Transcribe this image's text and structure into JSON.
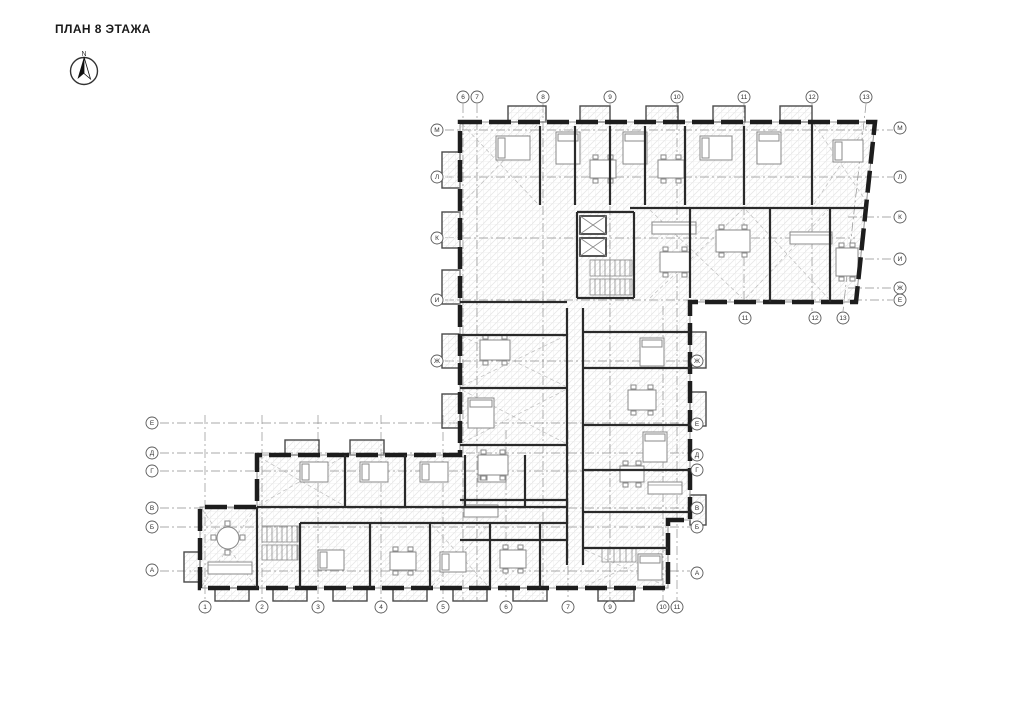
{
  "title": "ПЛАН 8 ЭТАЖА",
  "compass": {
    "north_label": "N"
  },
  "colors": {
    "wall": "#1d1d1d",
    "interior_wall": "#2a2a2a",
    "grid_line": "#8f8f8f",
    "bubble_stroke": "#5a5a5a",
    "bubble_text": "#333333",
    "furniture": "#8a8a8a",
    "balcony": "#4a4a4a",
    "diagonal": "#bdbdbd",
    "window": "#9a9a9a"
  },
  "axes": {
    "top_y": 97,
    "top": [
      {
        "label": "6",
        "x": 463
      },
      {
        "label": "7",
        "x": 477
      },
      {
        "label": "8",
        "x": 543
      },
      {
        "label": "9",
        "x": 610
      },
      {
        "label": "10",
        "x": 677
      },
      {
        "label": "11",
        "x": 744
      },
      {
        "label": "12",
        "x": 812
      },
      {
        "label": "13",
        "x": 866
      }
    ],
    "below_y": 318,
    "below_wing": [
      {
        "label": "11",
        "x": 745
      },
      {
        "label": "12",
        "x": 815
      },
      {
        "label": "13",
        "x": 843
      }
    ],
    "bottom_y": 607,
    "bottom": [
      {
        "label": "1",
        "x": 205
      },
      {
        "label": "2",
        "x": 262
      },
      {
        "label": "3",
        "x": 318
      },
      {
        "label": "4",
        "x": 381
      },
      {
        "label": "5",
        "x": 443
      },
      {
        "label": "6",
        "x": 506
      },
      {
        "label": "7",
        "x": 568
      },
      {
        "label": "9",
        "x": 610
      },
      {
        "label": "10",
        "x": 663
      },
      {
        "label": "11",
        "x": 677
      }
    ],
    "left_upper_x": 437,
    "left_upper": [
      {
        "label": "М",
        "y": 130
      },
      {
        "label": "Л",
        "y": 177
      },
      {
        "label": "К",
        "y": 238
      },
      {
        "label": "И",
        "y": 300
      },
      {
        "label": "Ж",
        "y": 361
      }
    ],
    "right_upper_x": 900,
    "right_upper": [
      {
        "label": "М",
        "y": 128
      },
      {
        "label": "Л",
        "y": 177
      },
      {
        "label": "К",
        "y": 217
      },
      {
        "label": "И",
        "y": 259
      },
      {
        "label": "Ж",
        "y": 288
      },
      {
        "label": "Е",
        "y": 300
      }
    ],
    "left_lower_x": 152,
    "left_lower": [
      {
        "label": "Е",
        "y": 423
      },
      {
        "label": "Д",
        "y": 453
      },
      {
        "label": "Г",
        "y": 471
      },
      {
        "label": "В",
        "y": 508
      },
      {
        "label": "Б",
        "y": 527
      },
      {
        "label": "А",
        "y": 570
      }
    ],
    "right_lower_x": 697,
    "right_lower": [
      {
        "label": "Ж",
        "y": 361
      },
      {
        "label": "Е",
        "y": 424
      },
      {
        "label": "Д",
        "y": 455
      },
      {
        "label": "Г",
        "y": 470
      },
      {
        "label": "В",
        "y": 508
      },
      {
        "label": "Б",
        "y": 527
      },
      {
        "label": "А",
        "y": 573
      }
    ]
  }
}
